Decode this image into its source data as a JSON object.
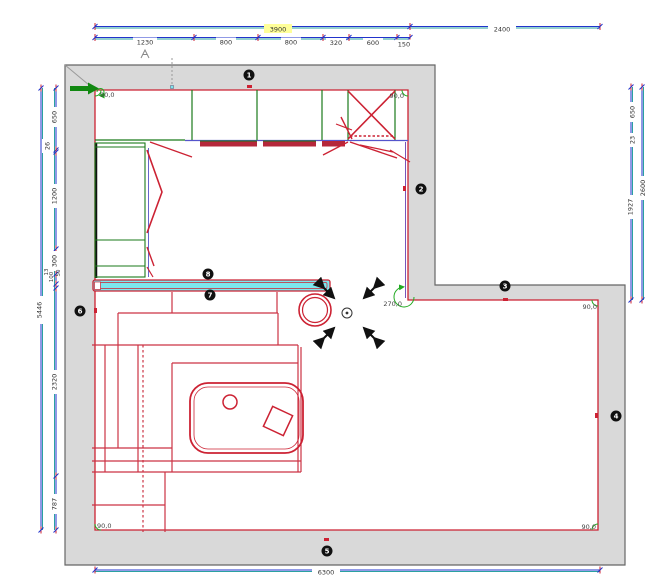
{
  "app": {
    "view": "kitchen-floorplan-top-view"
  },
  "dims": {
    "top_totals": [
      "3900",
      "2400"
    ],
    "top_segments": [
      "1230",
      "800",
      "800",
      "320",
      "600",
      "150"
    ],
    "left_total": "5446",
    "left_segments": [
      "650",
      "26",
      "1200",
      "300",
      "13",
      "100",
      "50",
      "2320",
      "787"
    ],
    "right_segments": [
      "650",
      "23",
      "1927"
    ],
    "right_total": "2600",
    "bottom_total": "6300"
  },
  "walls": {
    "numbers": [
      "1",
      "2",
      "3",
      "4",
      "5",
      "6",
      "7",
      "8"
    ]
  },
  "angles": [
    "90,0",
    "90,0",
    "270,0",
    "90,0",
    "90,0",
    "90,0"
  ],
  "colors": {
    "dimension_blue": "#2233cc",
    "dimension_teal": "#2aa1a1",
    "wall_fill": "#d9d9d9",
    "outline_red": "#cc2233",
    "cabinet_green": "#1a7a1a",
    "counter_cyan": "#7ce6ee",
    "entry_arrow_green": "#118811",
    "highlight_yellow": "#ffff99",
    "badge_black": "#111111"
  }
}
